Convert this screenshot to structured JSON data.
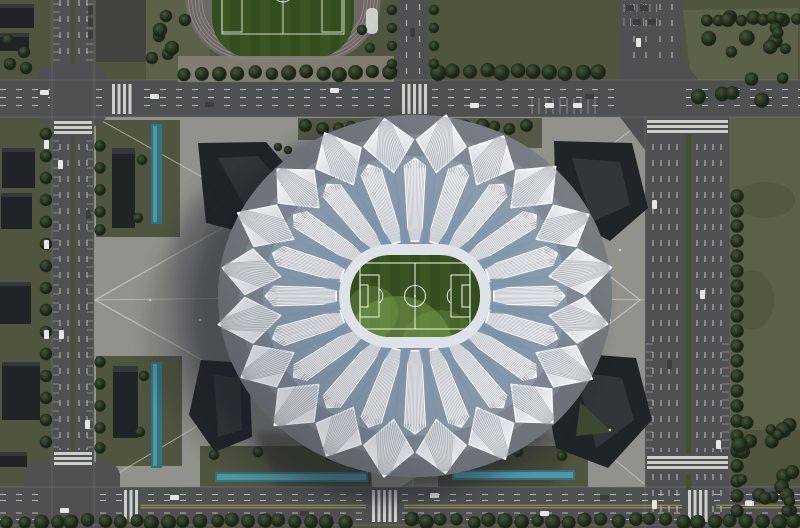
{
  "scene": {
    "description": "aerial-rendering-lotus-stadium-complex",
    "palette": {
      "grass": "#50553f",
      "grass_light": "#5c6249",
      "ground_dark": "#41443f",
      "road": "#4e5052",
      "lane_white": "#d9dad5",
      "lane_yellow": "#b3aa4d",
      "median": "#45522f",
      "plaza": "#8f9089",
      "path_line": "#cfd0c8",
      "gateway": "#9b9c95",
      "building": "#212427",
      "building_face": "#34383c",
      "stadium_base": "#6d7278",
      "stadium_mid": "#79828d",
      "bowl": "#8496a8",
      "petal_white": "#f4f6f8",
      "petal_shade": "#c9cfd7",
      "rib": "#8d949c",
      "wedge": "#7b93aa",
      "pitch": "#3a5424",
      "pitch_stripe": "#334d1e",
      "pitch_light": "#7ba04c",
      "pitch_line": "#e9efe4",
      "ring": "#dde3e9",
      "track": "#6e6965",
      "track_lane": "#9a948f",
      "water": "#2f7280",
      "water_light": "#6fb7c2",
      "tree_hi": "#45543a",
      "tree_lo": "#1c2617",
      "car_white": "#e6e7e4",
      "car_dark": "#3a3d40",
      "shadow": "#1d222b"
    },
    "stadium": {
      "outer_petals": 20,
      "inner_fans": 20,
      "blue_wedges": 20
    }
  }
}
